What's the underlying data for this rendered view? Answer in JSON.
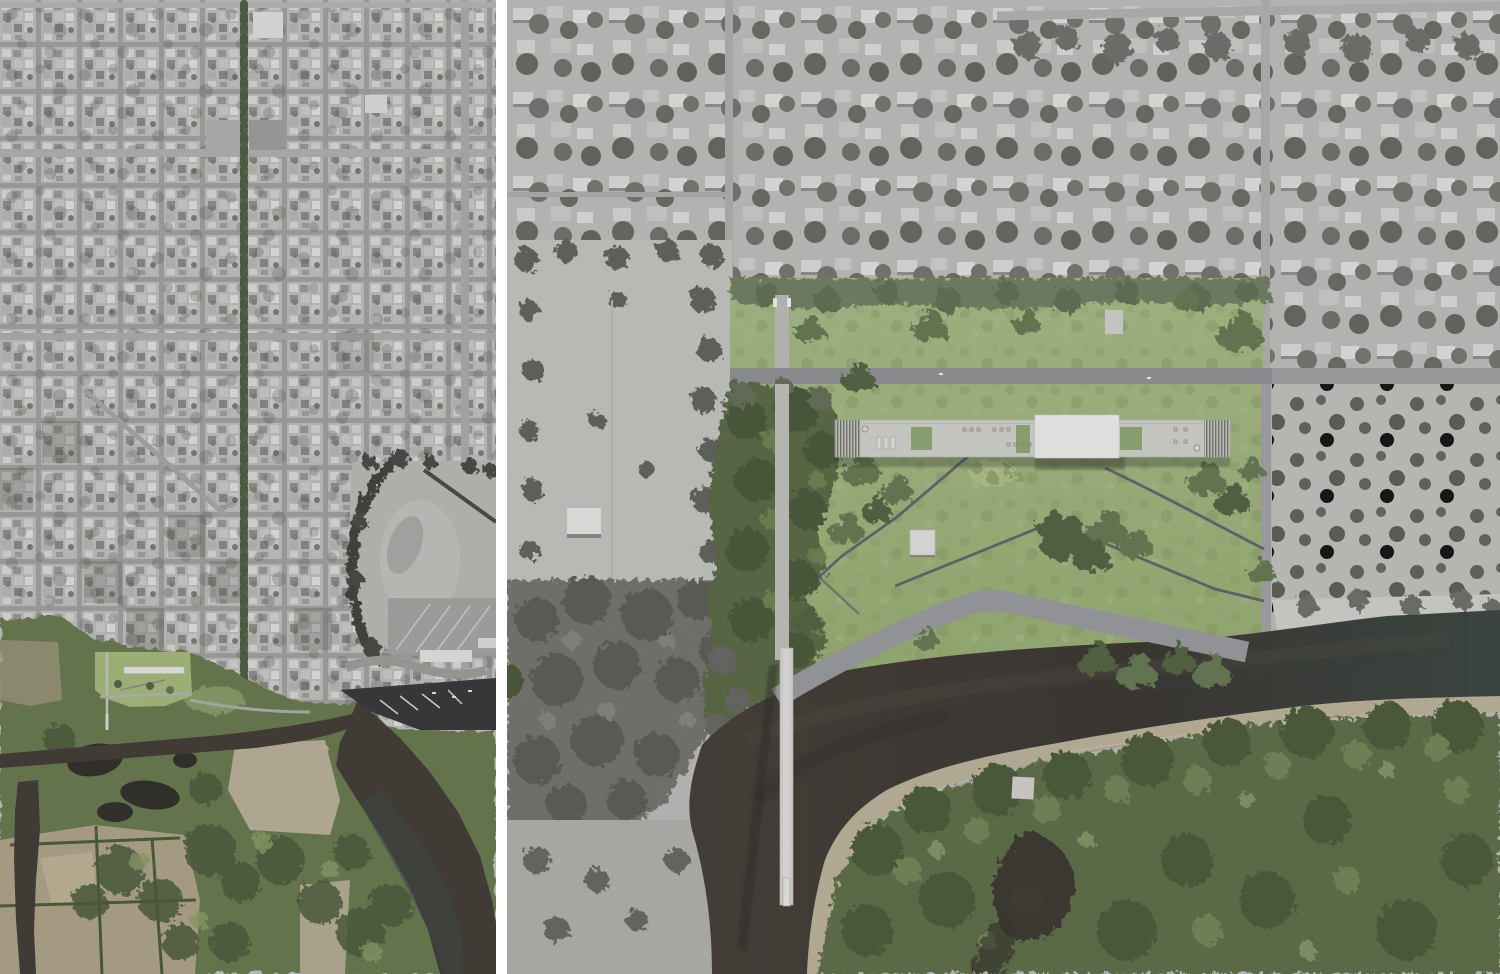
{
  "figure": {
    "type": "aerial-photo-montage",
    "panel_count": 2,
    "panels": {
      "left": {
        "label": "City-scale aerial photograph with tree-lined avenue leading to riverfront park site"
      },
      "right": {
        "label": "Enlarged aerial photograph with rendered park and museum site plan composited over the river bank"
      }
    }
  },
  "colors": {
    "gutter": "#ffffff",
    "water_dark": "#332c25",
    "water_teal": "#2e3a35",
    "sand_tan": "#c3b79c",
    "lawn_green": "#a3bc7c",
    "tree_render": "#5f7448",
    "tree_render_dark": "#495b36",
    "tree_render_light": "#7d9258",
    "photo_green": "#5e7643",
    "photo_green_dark": "#3d512c",
    "photo_green_light": "#86a05e",
    "gray_tree": "#61615b",
    "gray_tree_dark": "#4a4a44",
    "road_gray": "#8f9094",
    "promenade_gray": "#9b9ca1",
    "path_dark": "#5c5d66",
    "building_roof": "#dadad5",
    "building_white": "#fdfdfc",
    "courtyard_green": "#8fa96d",
    "bridge_white": "#edece8",
    "field_tan": "#b4a887",
    "shadow_dark": "#1f1c17",
    "city_base": "#c6c6c4",
    "suburb_base": "#c4c4c2",
    "avenue_green": "#3e5530"
  },
  "left_panel_features": [
    "city-grid",
    "tree-lined-avenue",
    "arterial-roads",
    "highlighted-park-site",
    "river-delta",
    "farm-fields",
    "oxbow-gravel-flat",
    "marina-docks",
    "wetland-ponds"
  ],
  "right_panel_features": [
    "suburban-grid",
    "site-lawn",
    "museum-roof",
    "roof-louvers",
    "roof-courtyards",
    "pedestrian-axis",
    "pedestrian-bridge",
    "riverside-promenade",
    "path-network",
    "pavilion",
    "river",
    "sandbar",
    "riparian-forest",
    "service-road",
    "scrubland"
  ]
}
